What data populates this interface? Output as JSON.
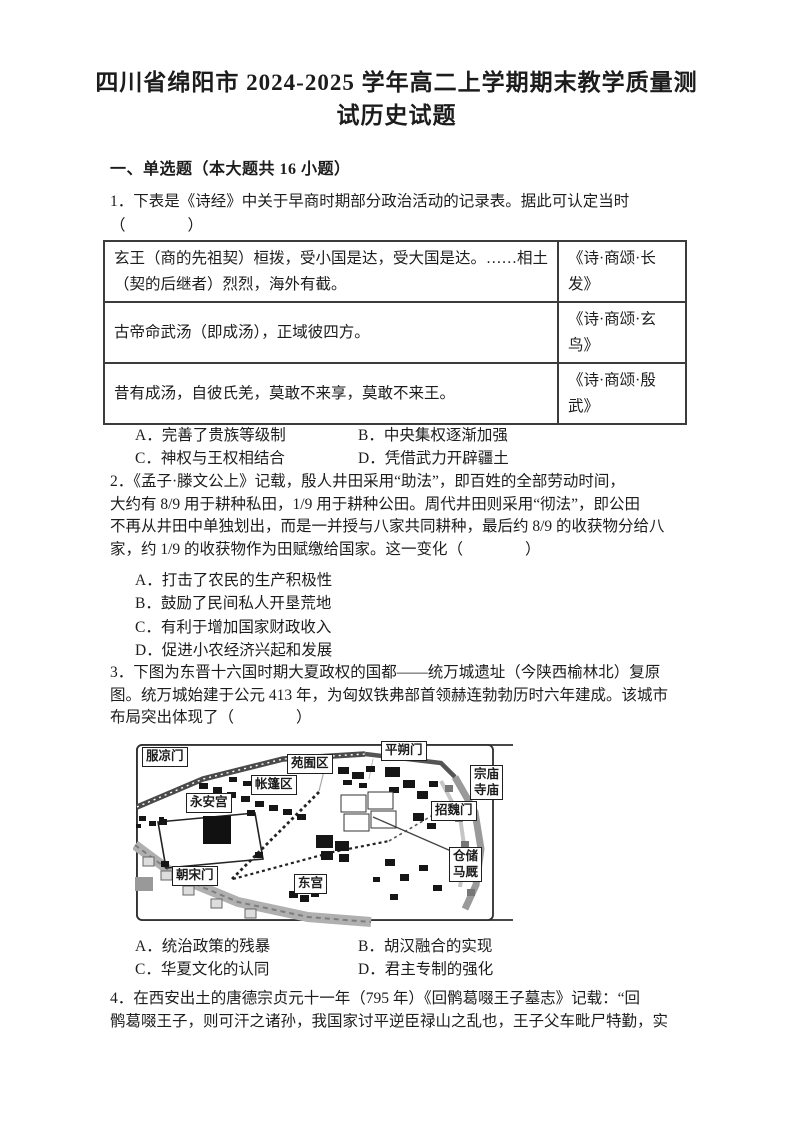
{
  "document": {
    "title_lines": [
      "四川省绵阳市 2024-2025 学年高二上学期期末教学质量测",
      "试历史试题"
    ],
    "section_heading": "一、单选题（本大题共 16 小题）"
  },
  "q1": {
    "stem_lines": [
      "1．下表是《诗经》中关于早商时期部分政治活动的记录表。据此可认定当时",
      "（　　　　）"
    ],
    "table_rows": [
      {
        "content": "玄王（商的先祖契）桓拨，受小国是达，受大国是达。……相土（契的后继者）烈烈，海外有截。",
        "source": "《诗·商颂·长发》"
      },
      {
        "content": "古帝命武汤（即成汤），正域彼四方。",
        "source": "《诗·商颂·玄鸟》"
      },
      {
        "content": "昔有成汤，自彼氏羌，莫敢不来享，莫敢不来王。",
        "source": "《诗·商颂·殷武》"
      }
    ],
    "options": {
      "A": "A．完善了贵族等级制",
      "B": "B．中央集权逐渐加强",
      "C": "C．神权与王权相结合",
      "D": "D．凭借武力开辟疆土"
    }
  },
  "q2": {
    "stem_lines": [
      "2．《孟子·滕文公上》记载，殷人井田采用“助法”，即百姓的全部劳动时间，",
      "大约有 8/9 用于耕种私田，1/9 用于耕种公田。周代井田则采用“彻法”，即公田",
      "不再从井田中单独划出，而是一并授与八家共同耕种，最后约 8/9 的收获物分给八",
      "家，约 1/9 的收获物作为田赋缴给国家。这一变化（　　　　）"
    ],
    "options": {
      "A": "A．打击了农民的生产积极性",
      "B": "B．鼓励了民间私人开垦荒地",
      "C": "C．有利于增加国家财政收入",
      "D": "D．促进小农经济兴起和发展"
    }
  },
  "q3": {
    "stem_lines": [
      "3．下图为东晋十六国时期大夏政权的国都——统万城遗址（今陕西榆林北）复原",
      "图。统万城始建于公元 413 年，为匈奴铁弗部首领赫连勃勃历时六年建成。该城市",
      "布局突出体现了（　　　　）"
    ],
    "figure": {
      "labels": {
        "west_gate": "服凉门",
        "garden_area": "苑囿区",
        "north_gate": "平朔门",
        "temple_line1": "宗庙",
        "temple_line2": "寺庙",
        "tent_area": "帐篷区",
        "yongan_palace": "永安宫",
        "east_gate": "招魏门",
        "storage_line1": "仓储",
        "storage_line2": "马厩",
        "south_gate": "朝宋门",
        "east_palace": "东宫"
      }
    },
    "options": {
      "A": "A．统治政策的残暴",
      "B": "B．胡汉融合的实现",
      "C": "C．华夏文化的认同",
      "D": "D．君主专制的强化"
    }
  },
  "q4": {
    "stem_lines": [
      "4．在西安出土的唐德宗贞元十一年（795 年）《回鹘葛啜王子墓志》记载：“回",
      "鹘葛啜王子，则可汗之诸孙，我国家讨平逆臣禄山之乱也，王子父车毗尸特勤，实"
    ]
  }
}
